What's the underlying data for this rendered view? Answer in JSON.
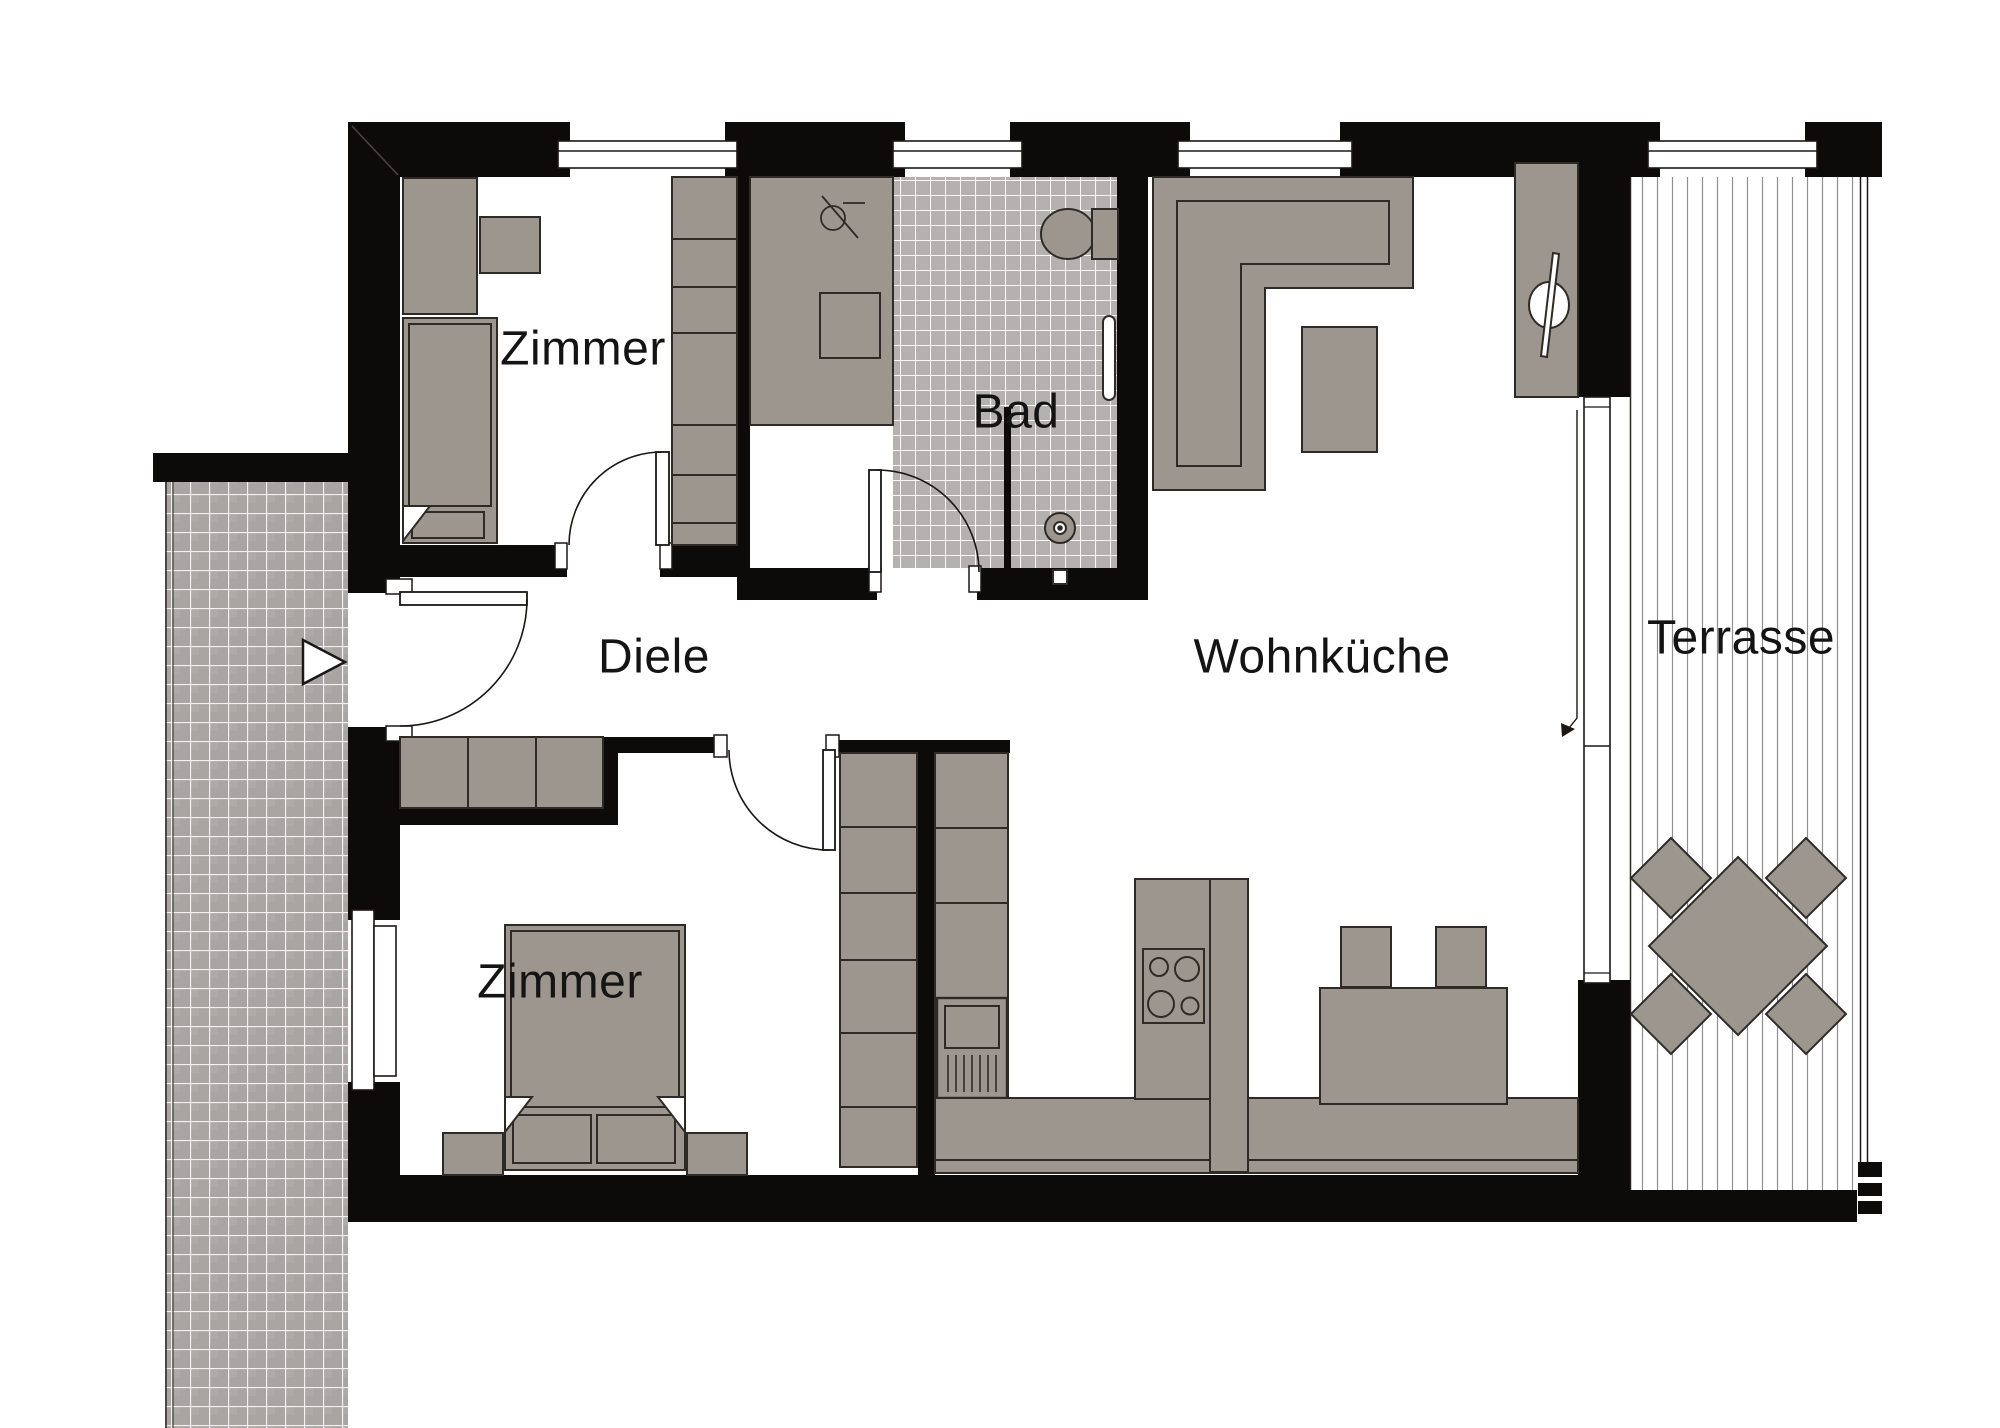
{
  "plan": {
    "type": "apartment-floor-plan",
    "rooms": {
      "zimmer_top": {
        "label": "Zimmer"
      },
      "bad": {
        "label": "Bad"
      },
      "diele": {
        "label": "Diele"
      },
      "wohnkueche": {
        "label": "Wohnküche"
      },
      "terrasse": {
        "label": "Terrasse"
      },
      "zimmer_bottom": {
        "label": "Zimmer"
      }
    },
    "palette": {
      "wall": "#0d0b09",
      "furniture": "#9d968e",
      "furniture_outline": "#2e2a26",
      "corridor_tile": "#a8a5a2",
      "bad_tile": "#b4b1ae",
      "deck_line": "#8f8f8f",
      "label_color": "#141414",
      "background": "#ffffff"
    }
  }
}
